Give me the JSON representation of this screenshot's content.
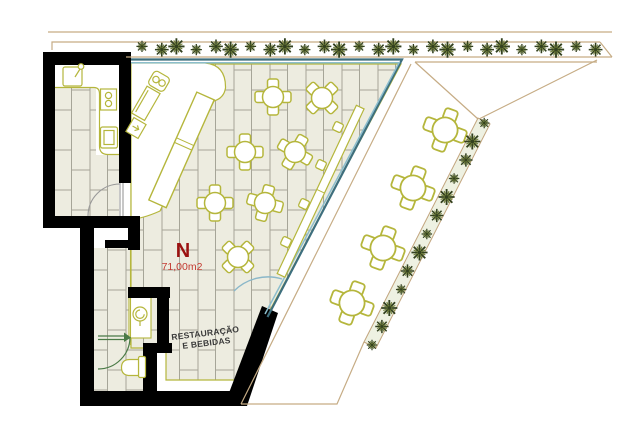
{
  "plan": {
    "room_tag": "N",
    "area": "71,00m2",
    "room_label_line1": "RESTAURAÇÃO",
    "room_label_line2": "E BEBIDAS"
  },
  "colors": {
    "wall": "#000000",
    "tile_fill": "#edece0",
    "tile_joint": "#a6a598",
    "furniture_outline": "#b5b63c",
    "glazing_dark": "#3e6f7e",
    "glazing_light": "#8cbecd",
    "boundary_tan": "#c6ac85",
    "plant_dark": "#33411f",
    "plant_light": "#72803c",
    "door_green": "#4a7a46",
    "door_arc_blue": "#8ab7c9",
    "door_arc_grey": "#999999",
    "tag_red": "#9b1111",
    "area_red": "#c33a31",
    "room_text": "#3a3a3a",
    "hedge_band_fill": "#eef1e2"
  },
  "furniture": {
    "dining_tables": [
      {
        "x": 273,
        "y": 97,
        "rot": 0
      },
      {
        "x": 322,
        "y": 98,
        "rot": 45
      },
      {
        "x": 245,
        "y": 152,
        "rot": 0
      },
      {
        "x": 295,
        "y": 152,
        "rot": 30
      },
      {
        "x": 215,
        "y": 203,
        "rot": 0
      },
      {
        "x": 265,
        "y": 203,
        "rot": 15
      },
      {
        "x": 238,
        "y": 257,
        "rot": 45
      }
    ],
    "terrace_tables": [
      {
        "x": 445,
        "y": 130,
        "rot": 20
      },
      {
        "x": 413,
        "y": 188,
        "rot": 20
      },
      {
        "x": 383,
        "y": 248,
        "rot": 20
      },
      {
        "x": 352,
        "y": 303,
        "rot": 20
      }
    ],
    "window_stools": [
      {
        "x": 338,
        "y": 127,
        "rot": 25
      },
      {
        "x": 321,
        "y": 165,
        "rot": 25
      },
      {
        "x": 304,
        "y": 204,
        "rot": 25
      },
      {
        "x": 286,
        "y": 242,
        "rot": 25
      }
    ]
  },
  "landscaping": {
    "top_hedge": {
      "x_start": 142,
      "x_end": 594,
      "y": 48,
      "count": 26
    },
    "diagonal_hedge": {
      "x1": 372,
      "y1": 345,
      "x2": 483,
      "y2": 123,
      "count": 13
    }
  }
}
